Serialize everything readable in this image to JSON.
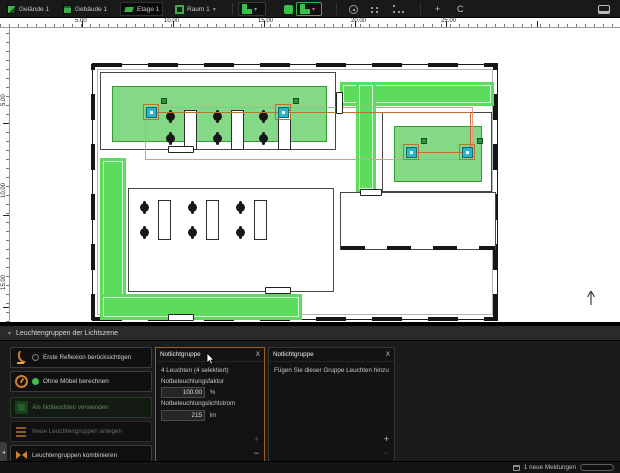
{
  "toolbar": {
    "items": [
      {
        "label": "Gelände 1"
      },
      {
        "label": "Gebäude 1"
      },
      {
        "label": "Etage 1"
      },
      {
        "label": "Raum 1"
      }
    ]
  },
  "icons": {
    "caret_down": "▾",
    "collapse_left": "◂",
    "move": "+",
    "rotate": "C"
  },
  "rulers": {
    "top_labels": [
      "5.00",
      "10.00",
      "15.00",
      "20.00",
      "25.00"
    ],
    "left_labels": [
      "5.00",
      "10.00",
      "15.00"
    ]
  },
  "panel": {
    "caret": "▾",
    "title": "Leuchtengruppen der Lichtszene",
    "buttons": [
      {
        "label": "Erste Reflexion berücksichtigen"
      },
      {
        "label": "Ohne Möbel berechnen"
      },
      {
        "label": "Als Notleuchten verwenden"
      },
      {
        "label": "Neue Leuchtengruppen anlegen"
      },
      {
        "label": "Leuchtengruppen kombinieren"
      }
    ],
    "group1": {
      "title": "Notlichtgruppe",
      "close": "X",
      "count_text": "4 Leuchten (4 selektiert)",
      "factor_label": "Notbeleuchtungsfaktor",
      "factor_value": "100.00",
      "factor_unit": "%",
      "flux_label": "Notbeleuchtungslichtstrom",
      "flux_value": "215",
      "flux_unit": "lm",
      "add": "+",
      "remove": "−"
    },
    "group2": {
      "title": "Notlichtgruppe",
      "close": "X",
      "hint": "Fügen Sie dieser Gruppe Leuchten hinzu",
      "add": "+",
      "remove": "−"
    }
  },
  "statusbar": {
    "messages": "1 neue Meldungen"
  },
  "colors": {
    "accent_orange": "#9b5c24",
    "selection_red": "#f29090",
    "luminaire_teal": "#2ab5c8",
    "zone_green": "#85d885",
    "corridor_green": "#5cdb5c",
    "toolbar_green": "#3fae4a"
  }
}
